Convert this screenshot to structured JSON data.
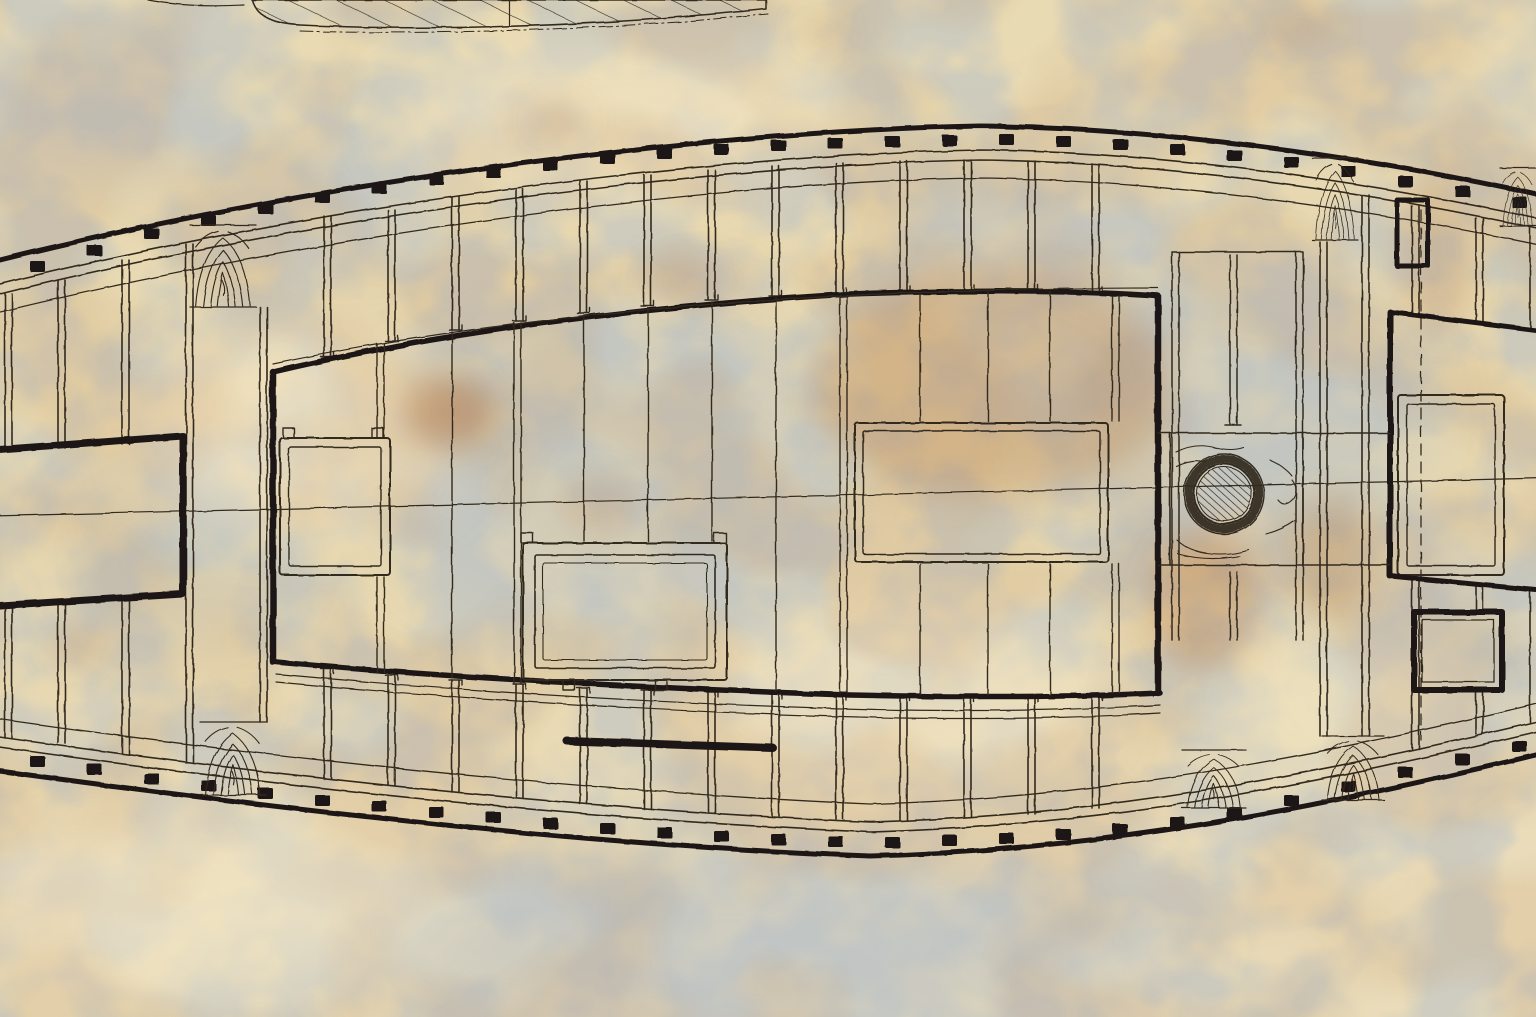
{
  "artifact": {
    "kind": "photographed archival ship drawing",
    "main_view": "deck framing plan (midship portion, lens-shaped hull clipped at both sides)",
    "secondary_view": "bottom edge of keel/profile drawing with diagonal section hatching (top of photo)",
    "visible_text": "none"
  },
  "colors": {
    "paper": "#e8d9b2",
    "paper_light": "#f2e6c6",
    "blue_wash": "#b3bdc7",
    "rust": "#b5814d",
    "rust_strong": "#b06f33",
    "ink": "#32291f",
    "ink_heavy": "#1f1813"
  },
  "diagram": {
    "features": [
      "thick outer hull planking outline",
      "black frame-head marks spaced along inside of hull line",
      "double clamp band and stringer lines parallel to hull",
      "transverse deck beams drawn as double lines with notched ends",
      "heavy carling boundary enclosing midship framed area",
      "hatch openings with double rounded coamings and corner lugs",
      "mast partner block with wood grain and hatched mast hole",
      "wood-grain knee/chock blocks between beams",
      "fore-aft centerline",
      "dashed station line near right side",
      "large heavy-bordered opening at left edge"
    ],
    "counts": {
      "frame_marks_top": 27,
      "frame_marks_bottom": 27,
      "hatch_openings": 5,
      "heavy_bordered_openings": 2,
      "mast_holes": 1,
      "wood_grain_blocks": 6
    },
    "condition": "aged cream paper, blue-gray mottling, rust foxing stains, eroded ink lines"
  }
}
